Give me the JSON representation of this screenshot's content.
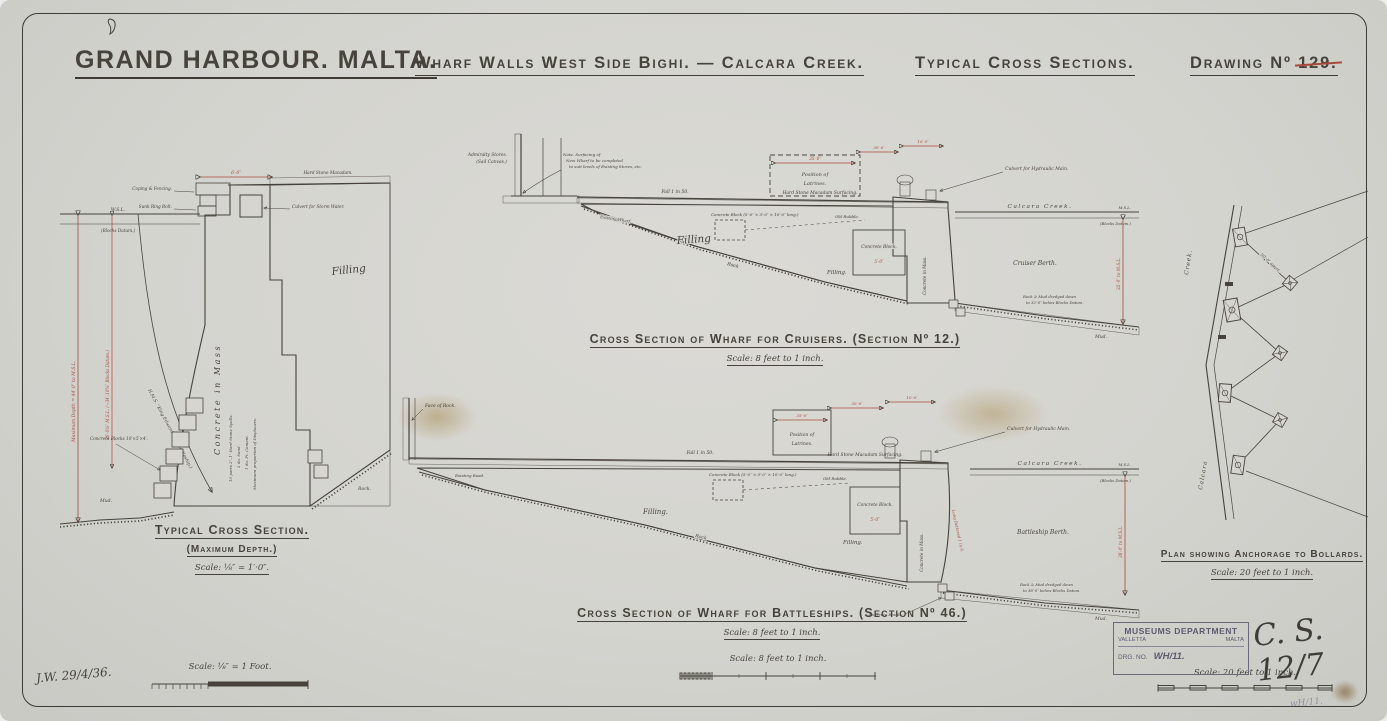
{
  "title": {
    "main": "GRAND HARBOUR. MALTA.",
    "sub": "Wharf Walls West Side Bighi. — Calcara Creek.",
    "sections": "Typical Cross Sections.",
    "drawing_label": "Drawing Nº ",
    "drawing_number": "129."
  },
  "typical": {
    "caption": "Typical Cross Section.",
    "subcaption": "(Maximum Depth.)",
    "scale": "Scale: ⅛″ = 1′·0″.",
    "labels": {
      "coping": "Coping & Fencing.",
      "ring_bolt": "Sunk Ring Bolt.",
      "macadam": "Hard Stone Macadam.",
      "culvert": "Culvert for Storm Water.",
      "top_dim": "6′·0″",
      "wsl": "W.S.L.",
      "datum": "(Blocks Datum.)",
      "filling": "Filling",
      "concrete": "Concrete in Mass",
      "spec1": "10 parts 2″–1″ Hard Stone Spalls.",
      "spec2": "2 do. Sand.",
      "spec3": "1 do. Pt. Cement.",
      "spec4": "Maximum proportion of Displacers.",
      "depth_dim": "Maximum Depth = 44′·0″ to M.S.L.",
      "mid_dim": "36′·0⅜″ M.S.L. (−34′·10⅜″ Blocks Datum.)",
      "ship": "H.M.S. “King Edward VII” (Battleship.)",
      "blocks": "Concrete Blocks 10′×5′×4′.",
      "mud": "Mud.",
      "rock": "Rock."
    }
  },
  "cruisers": {
    "caption_main": "Cross Section of Wharf for Cruisers.",
    "caption_section": "(Section Nº 12.)",
    "scale": "Scale: 8 feet to 1 inch.",
    "labels": {
      "stores1": "Admiralty Stores.",
      "stores2": "(Sail Canvas.)",
      "note1": "Note. Surfacing of",
      "note2": "New Wharf to be completed",
      "note3": "to suit levels of Existing Stores, etc.",
      "fall": "Fall 1 in 50.",
      "macadam": "Hard Stone Macadam Surfacing.",
      "latrines1": "Position of",
      "latrines2": "Latrines.",
      "latrines_dim": "35′·0″",
      "dim_30": "30′·0″",
      "dim_10": "10′·0″",
      "existing": "Existing Wharf.",
      "filling_big": "Filling",
      "filling2": "Filling.",
      "rock_slope": "Rock",
      "block_note": "Concrete Block (5′·0″ × 5′·0″ × 10′·0″ long.)",
      "old_rubble": "Old Rubble.",
      "concrete_block": "Concrete Block.",
      "block_dim": "5′·0″",
      "wall_vert": "Concrete in Mass.",
      "culvert": "Culvert for Hydraulic Main.",
      "creek": "Calcara Creek.",
      "msl": "M.S.L.",
      "datum": "(Blocks Datum.)",
      "berth": "Cruiser Berth.",
      "depth_dim": "32′·0″ to M.S.L.",
      "dredge1": "Rock & Mud dredged down",
      "dredge2": "to 32′·0″ below Blocks Datum.",
      "mud": "Mud."
    }
  },
  "battleships": {
    "caption_main": "Cross Section of Wharf for Battleships.",
    "caption_section": "(Section Nº 46.)",
    "scale": "Scale: 8 feet to 1 inch.",
    "labels": {
      "face_rock": "Face of Rock.",
      "existing": "Existing Road.",
      "fall": "Fall 1 in 50.",
      "macadam": "Hard Stone Macadam Surfacing.",
      "latrines1": "Position of",
      "latrines2": "Latrines.",
      "latrines_dim": "35′·0″",
      "dim_30": "30′·0″",
      "dim_10": "10′·0″",
      "filling1": "Filling.",
      "filling2": "Filling.",
      "rock_slope": "Rock",
      "block_note": "Concrete Block (5′·0″ × 5′·0″ × 10′·0″ long.)",
      "old_rubble": "Old Rubble.",
      "concrete_block": "Concrete Block.",
      "block_dim": "5′·0″",
      "wall_vert": "Concrete in Mass.",
      "batter": "Long Battered 1 in 8.",
      "culvert": "Culvert for Hydraulic Main.",
      "creek": "Calcara Creek.",
      "msl": "M.S.L.",
      "datum": "(Blocks Datum.)",
      "berth": "Battleship Berth.",
      "depth_dim": "38′·0″ to M.S.L.",
      "dredge1": "Rock & Mud dredged down",
      "dredge2": "to 38′·0″ below Blocks Datum.",
      "mud": "Mud.",
      "toe_blocks": "Concrete Blocks."
    }
  },
  "plan": {
    "caption": "Plan showing Anchorage to Bollards.",
    "scale": "Scale: 20 feet to 1 inch.",
    "labels": {
      "creek": "Creek.",
      "calcara": "Calcara",
      "tie_dim": "50′·0″ apart."
    }
  },
  "scalebars": {
    "left": "Scale: ⅛″ = 1 Foot.",
    "middle": "Scale: 8 feet to 1 inch.",
    "right": "Scale: 20 feet to 1 inch."
  },
  "stamp": {
    "line1": "MUSEUMS DEPARTMENT",
    "city": "VALLETTA",
    "country": "MALTA",
    "drg_label": "DRG. NO.",
    "drg_value": "WH/11."
  },
  "annotations": {
    "signature": "J.W. 29/4/36.",
    "reference": "C. S. 12/7",
    "pencil": "wH/11."
  },
  "colors": {
    "paper": "#d6d5d0",
    "ink": "#45433b",
    "red": "#a9493b",
    "stamp": "#5d5a6e"
  }
}
